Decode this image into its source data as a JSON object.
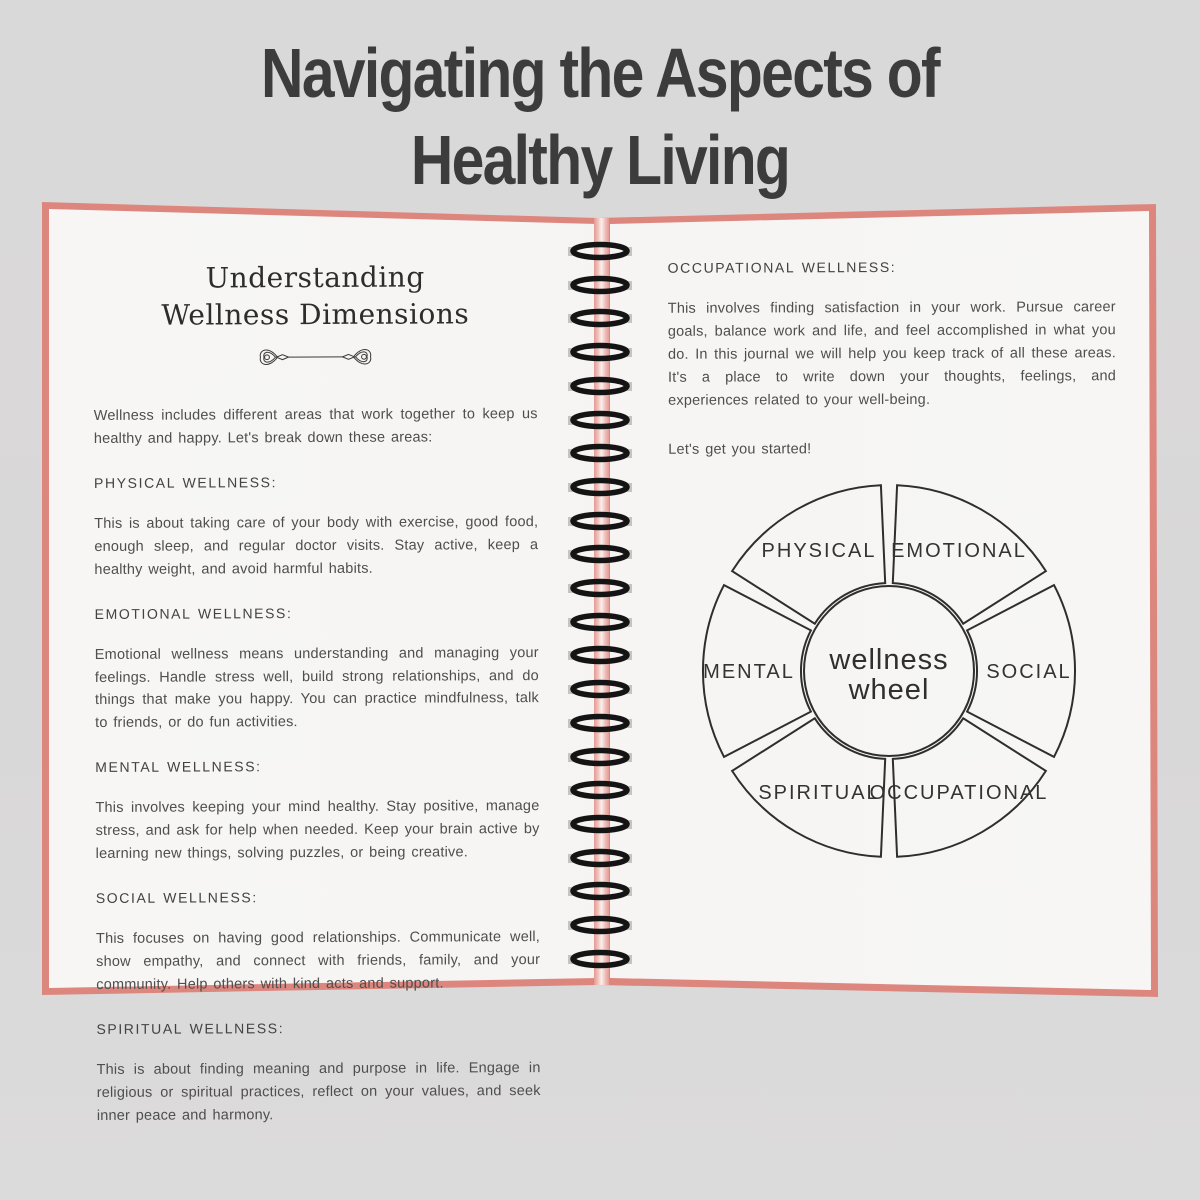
{
  "title": {
    "line1": "Navigating the Aspects of",
    "line2": "Healthy Living"
  },
  "left_page": {
    "heading_line1": "Understanding",
    "heading_line2": "Wellness Dimensions",
    "intro": "Wellness includes different areas that work together to keep us healthy and happy. Let's break down these areas:",
    "sections": [
      {
        "heading": "PHYSICAL WELLNESS:",
        "body": "This is about taking care of your body with exercise, good food, enough sleep, and regular doctor visits. Stay active, keep a healthy weight, and avoid harmful habits."
      },
      {
        "heading": "EMOTIONAL WELLNESS:",
        "body": "Emotional wellness means understanding and managing your feelings. Handle stress well, build strong relationships, and do things that make you happy. You can practice mindfulness, talk to friends, or do fun activities."
      },
      {
        "heading": "MENTAL WELLNESS:",
        "body": "This involves keeping your mind healthy. Stay positive, manage stress, and ask for help when needed. Keep your brain active by learning new things, solving puzzles, or being creative."
      },
      {
        "heading": "SOCIAL WELLNESS:",
        "body": "This focuses on having good relationships. Communicate well, show empathy, and connect with friends, family, and your community. Help others with kind acts and support."
      },
      {
        "heading": "SPIRITUAL WELLNESS:",
        "body": "This is about finding meaning and purpose in life. Engage in religious or spiritual practices, reflect on your values, and seek inner peace and harmony."
      }
    ]
  },
  "right_page": {
    "section": {
      "heading": "OCCUPATIONAL WELLNESS:",
      "body": "This involves finding satisfaction in your work. Pursue career goals, balance work and life, and feel accomplished in what you do. In this journal we will help you keep track of all these areas. It's a place to write down your thoughts, feelings, and experiences related to your well-being."
    },
    "cta": "Let's get you started!",
    "wheel": {
      "center_line1": "wellness",
      "center_line2": "wheel",
      "segments": [
        {
          "label": "PHYSICAL",
          "angle": 120
        },
        {
          "label": "EMOTIONAL",
          "angle": 60
        },
        {
          "label": "MENTAL",
          "angle": 180
        },
        {
          "label": "SOCIAL",
          "angle": 0
        },
        {
          "label": "SPIRITUAL",
          "angle": 240
        },
        {
          "label": "OCCUPATIONAL",
          "angle": 300
        }
      ]
    }
  },
  "colors": {
    "background": "#d9d8d8",
    "cover_pink": "#dd867e",
    "page": "#f6f5f3",
    "ink": "#4e4e4e",
    "title_ink": "#3d3c3c",
    "wheel_stroke": "#2e2e2e",
    "coil_black": "#141414"
  }
}
